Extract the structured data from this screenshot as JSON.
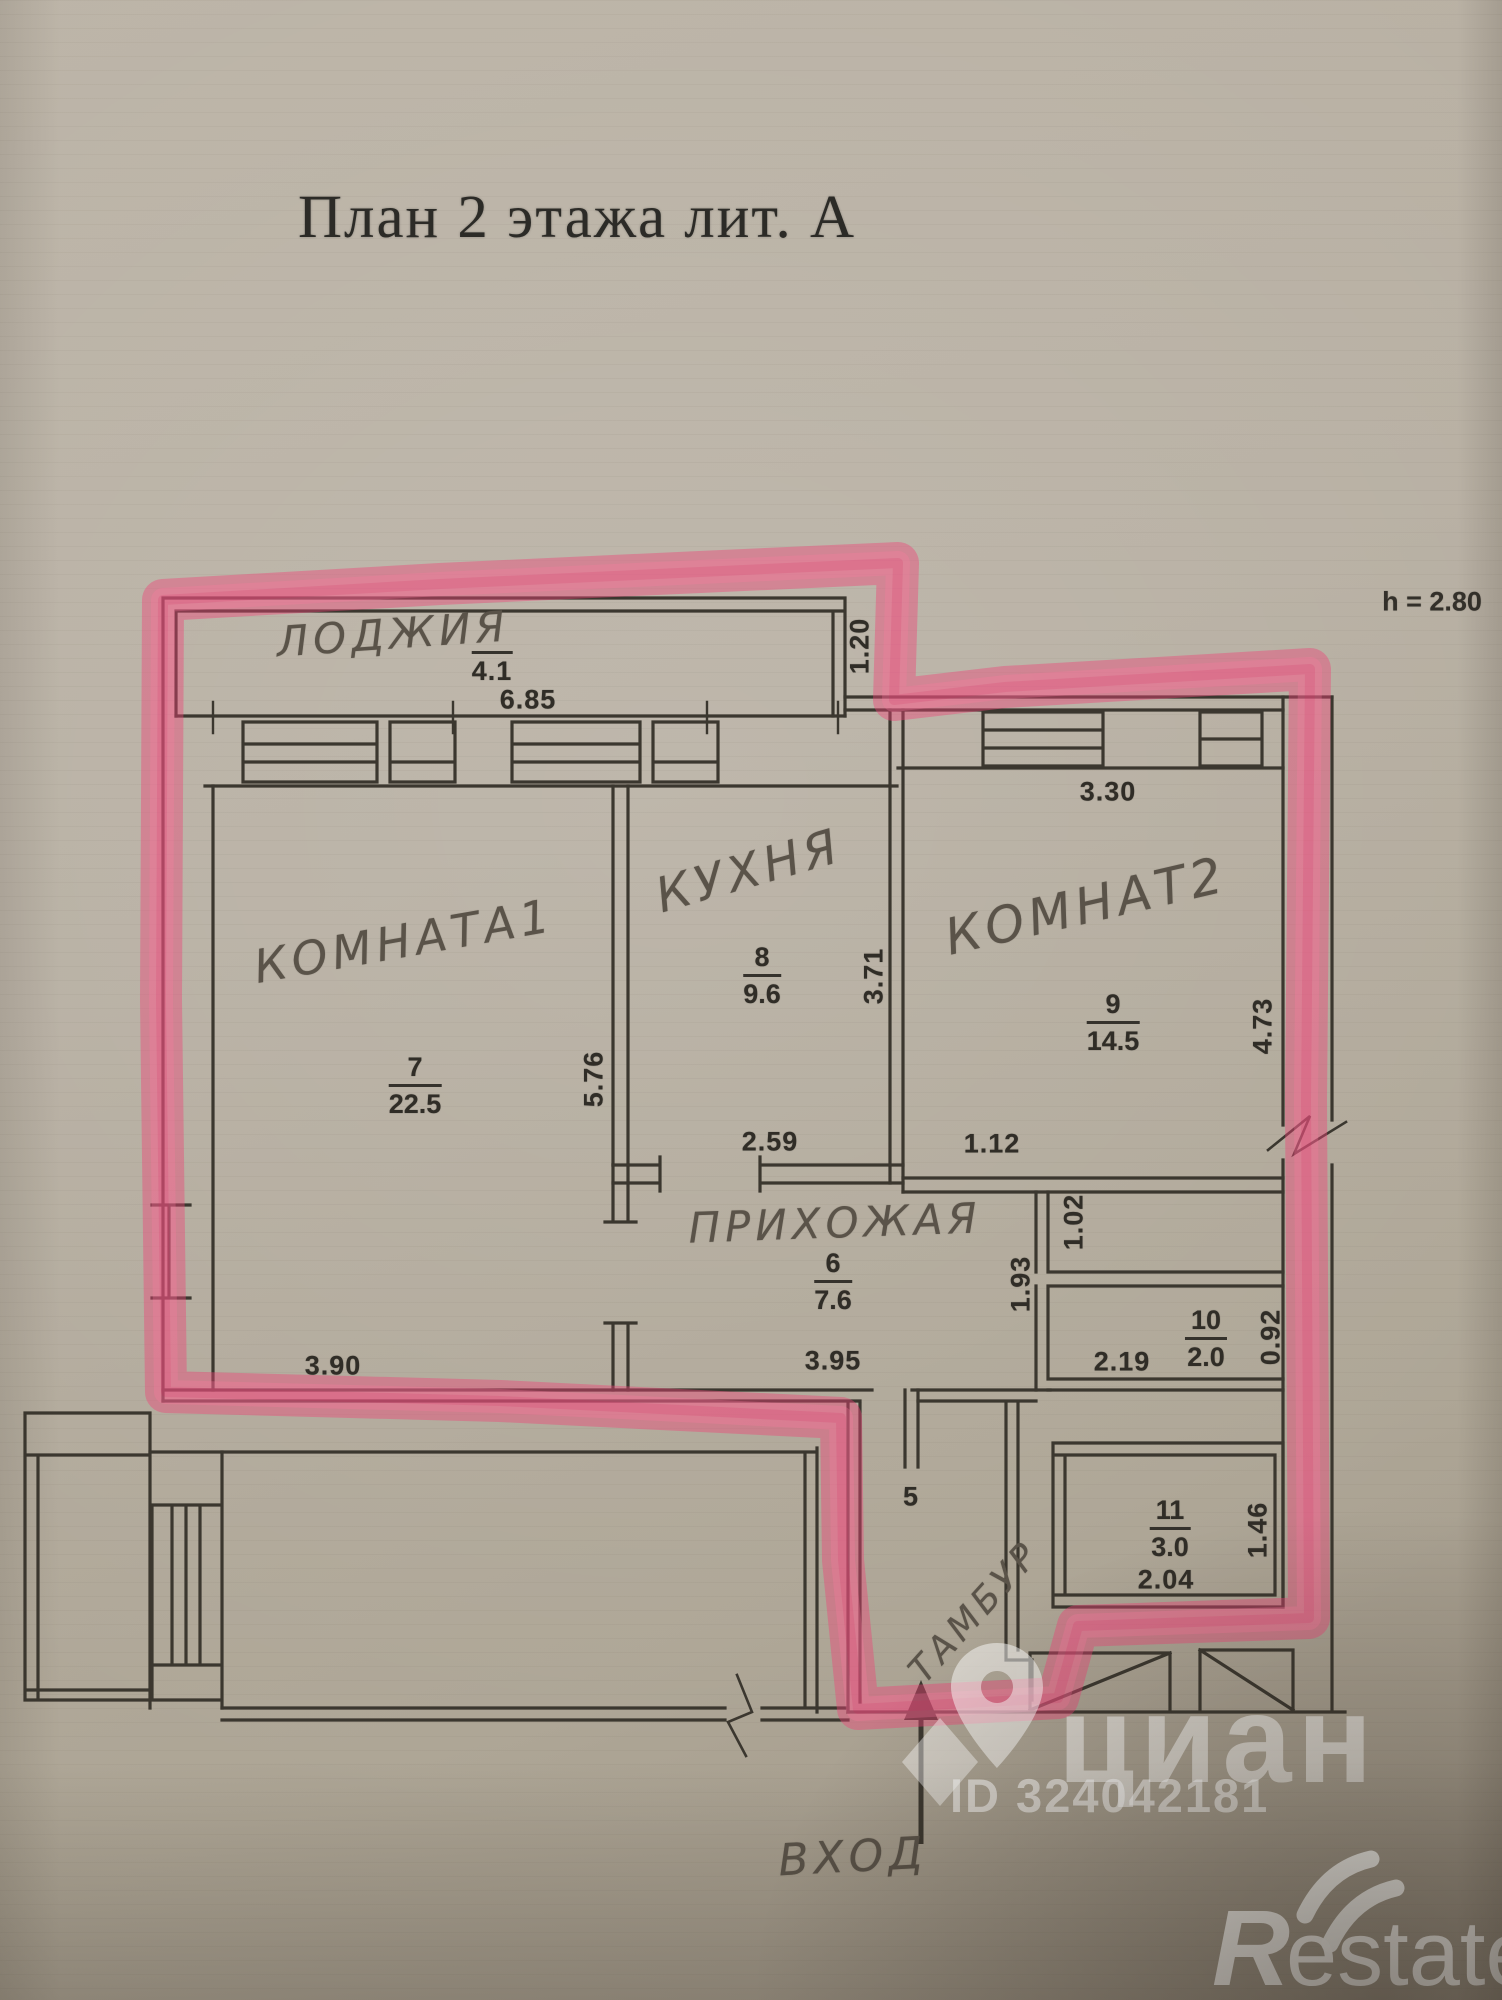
{
  "title": "План 2 этажа лит. А",
  "ceiling_height_note": "h = 2.80",
  "colors": {
    "highlighter": "#ee4377",
    "ink": "#3b372f",
    "pencil": "#5a5349",
    "paper": "#b7afa2",
    "watermark": "#ffffff"
  },
  "handwritten_labels": [
    {
      "text": "ЛОДЖИЯ",
      "x": 393,
      "y": 634,
      "rot": -4,
      "size": 42
    },
    {
      "text": "КОМНАТА1",
      "x": 404,
      "y": 941,
      "rot": -10,
      "size": 46
    },
    {
      "text": "КУХНЯ",
      "x": 749,
      "y": 871,
      "rot": -16,
      "size": 48
    },
    {
      "text": "КОМНАТ2",
      "x": 1086,
      "y": 906,
      "rot": -13,
      "size": 50
    },
    {
      "text": "ПРИХОЖАЯ",
      "x": 835,
      "y": 1223,
      "rot": -2,
      "size": 42
    },
    {
      "text": "ТАМБУР",
      "x": 975,
      "y": 1612,
      "rot": -48,
      "size": 36
    },
    {
      "text": "ВХОД",
      "x": 853,
      "y": 1857,
      "rot": -3,
      "size": 44
    }
  ],
  "dimension_labels": [
    {
      "text": "4.1",
      "x": 492,
      "y": 669,
      "rot": 0,
      "overline": true
    },
    {
      "text": "6.85",
      "x": 528,
      "y": 700,
      "rot": 0
    },
    {
      "text": "1.20",
      "x": 860,
      "y": 646,
      "rot": -90
    },
    {
      "text": "3.30",
      "x": 1108,
      "y": 792,
      "rot": 0
    },
    {
      "text": "3.71",
      "x": 874,
      "y": 976,
      "rot": -90
    },
    {
      "text": "5.76",
      "x": 594,
      "y": 1079,
      "rot": -90
    },
    {
      "text": "2.59",
      "x": 770,
      "y": 1142,
      "rot": 0
    },
    {
      "text": "1.12",
      "x": 992,
      "y": 1144,
      "rot": 0
    },
    {
      "text": "1.02",
      "x": 1074,
      "y": 1222,
      "rot": -90
    },
    {
      "text": "1.93",
      "x": 1021,
      "y": 1284,
      "rot": -90
    },
    {
      "text": "4.73",
      "x": 1263,
      "y": 1026,
      "rot": -90
    },
    {
      "text": "3.95",
      "x": 833,
      "y": 1361,
      "rot": 0
    },
    {
      "text": "3.90",
      "x": 333,
      "y": 1366,
      "rot": 0
    },
    {
      "text": "2.19",
      "x": 1122,
      "y": 1362,
      "rot": 0
    },
    {
      "text": "0.92",
      "x": 1271,
      "y": 1337,
      "rot": -90
    },
    {
      "text": "2.04",
      "x": 1166,
      "y": 1580,
      "rot": 0
    },
    {
      "text": "1.46",
      "x": 1258,
      "y": 1530,
      "rot": -90
    },
    {
      "text": "5",
      "x": 911,
      "y": 1497,
      "rot": 0
    }
  ],
  "room_fractions": [
    {
      "num": "7",
      "den": "22.5",
      "x": 415,
      "y": 1086
    },
    {
      "num": "8",
      "den": "9.6",
      "x": 762,
      "y": 976
    },
    {
      "num": "9",
      "den": "14.5",
      "x": 1113,
      "y": 1023
    },
    {
      "num": "6",
      "den": "7.6",
      "x": 833,
      "y": 1282
    },
    {
      "num": "10",
      "den": "2.0",
      "x": 1206,
      "y": 1339
    },
    {
      "num": "11",
      "den": "3.0",
      "x": 1170,
      "y": 1529
    }
  ],
  "watermark": {
    "brand": "циан",
    "id_text": "ID 324042181"
  },
  "footer_logo": {
    "brand_r": "R",
    "brand_rest": "estate"
  }
}
